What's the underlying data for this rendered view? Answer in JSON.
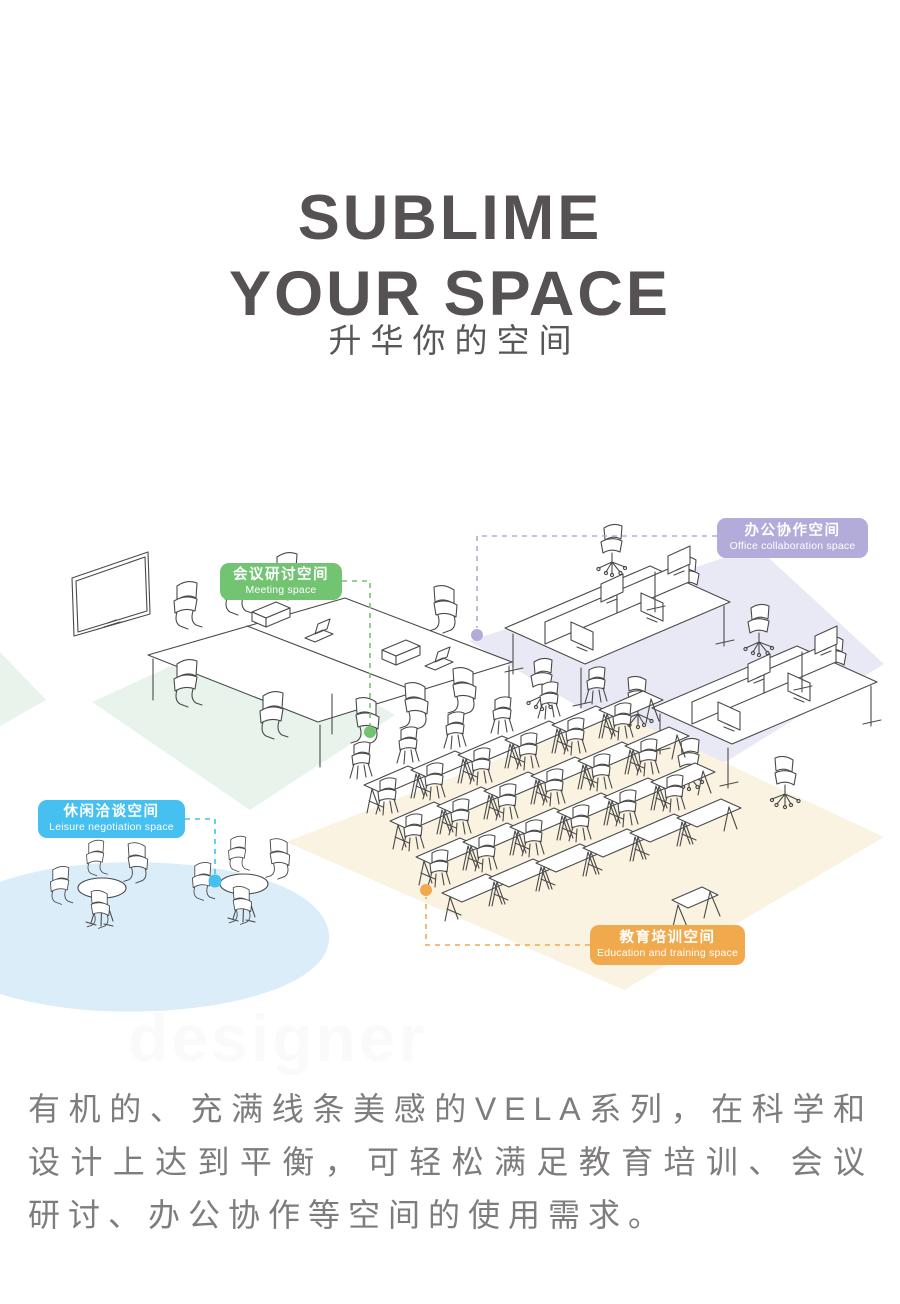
{
  "header": {
    "title_line1": "SUBLIME",
    "title_line2": "YOUR SPACE",
    "subtitle": "升华你的空间"
  },
  "diagram": {
    "labels": [
      {
        "id": "meeting",
        "zh": "会议研讨空间",
        "en": "Meeting space",
        "color": "#72c372"
      },
      {
        "id": "office",
        "zh": "办公协作空间",
        "en": "Office collaboration space",
        "color": "#b3abd9"
      },
      {
        "id": "leisure",
        "zh": "休闲洽谈空间",
        "en": "Leisure negotiation space",
        "color": "#45c0f0"
      },
      {
        "id": "training",
        "zh": "教育培训空间",
        "en": "Education and training space",
        "color": "#f0a94c"
      }
    ],
    "floor_colors": {
      "meeting": "#e8f3ec",
      "office": "#e9e9f6",
      "leisure": "#daedf9",
      "training": "#faf3e1"
    }
  },
  "watermark": "designer",
  "paragraph": {
    "line1": "有机的、充满线条美感的VELA系列，在科学和",
    "line2": "设计上达到平衡，可轻松满足教育培训、会议",
    "line3": "研讨、办公协作等空间的使用需求。"
  },
  "colors": {
    "title_text": "#565254",
    "paragraph_text": "#7f7c7c",
    "line_art": "#4a4a4a"
  }
}
